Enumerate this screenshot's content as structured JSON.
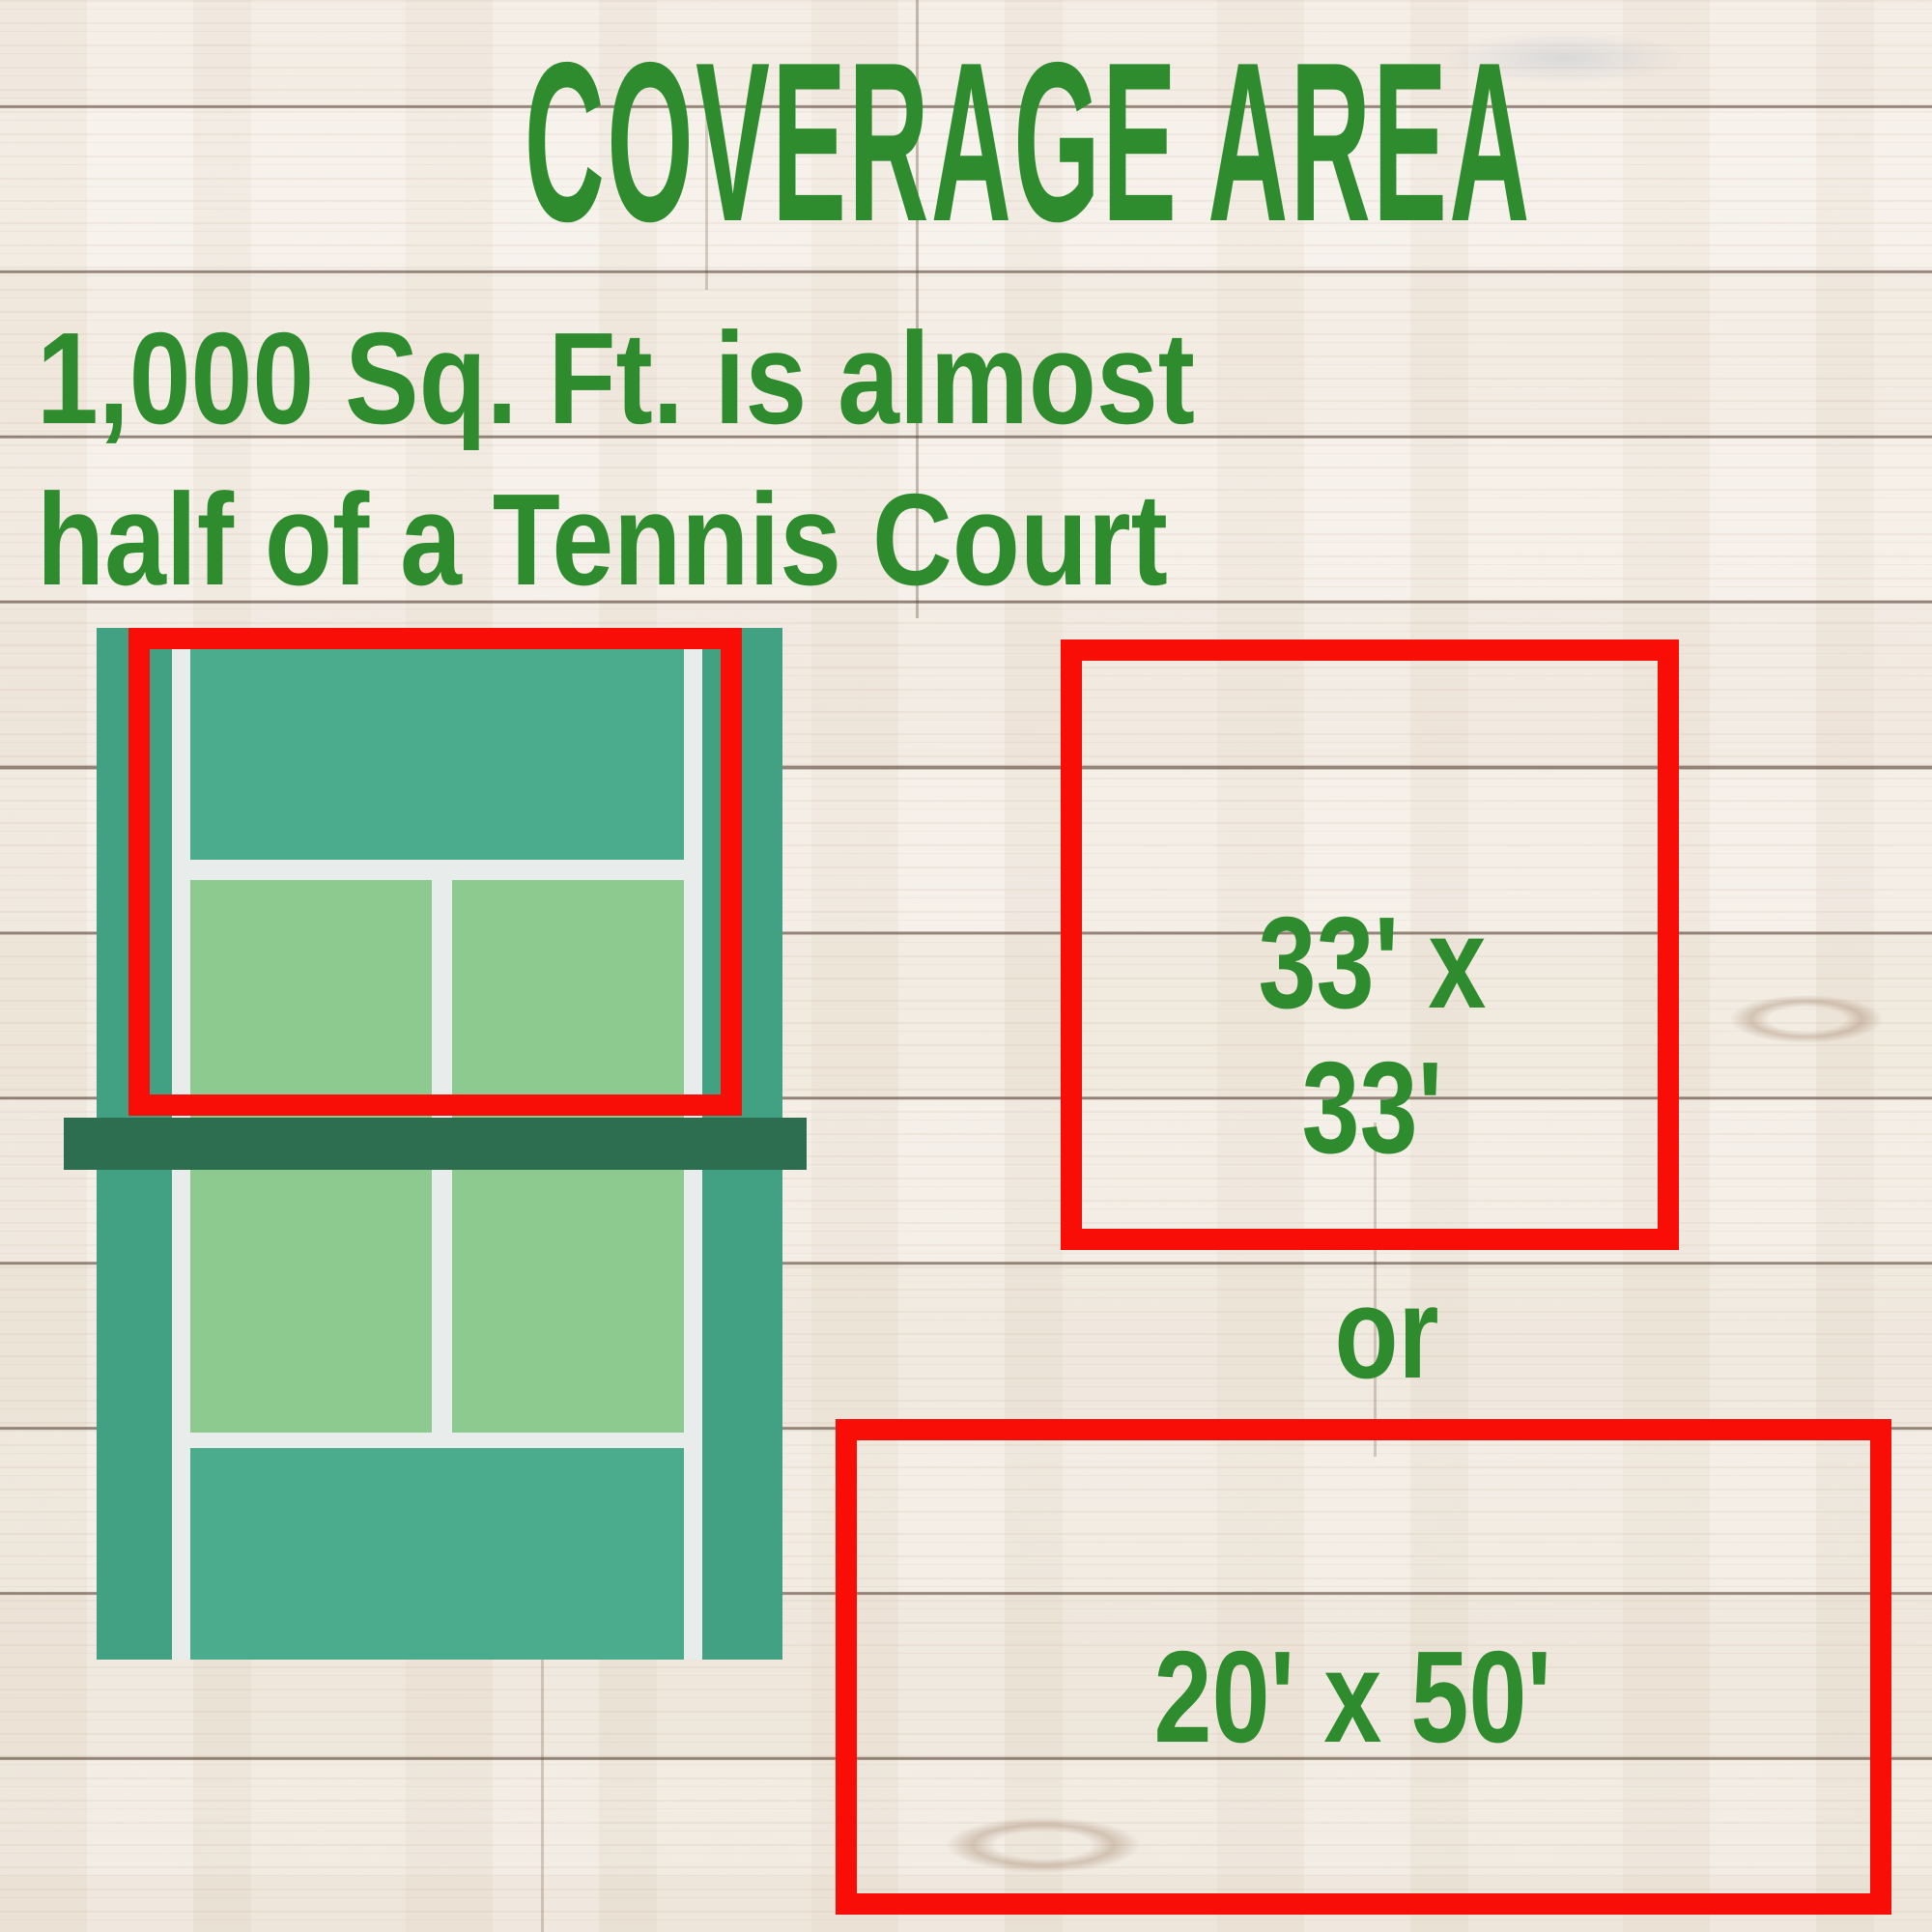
{
  "title": "COVERAGE AREA",
  "subtitle": {
    "line1": "1,000 Sq. Ft. is almost",
    "line2": "half of a Tennis Court"
  },
  "dimension_options": {
    "square_label_line1": "33' x",
    "square_label_line2": "33'",
    "separator": "or",
    "rectangle_label": "20' x 50'"
  },
  "colors": {
    "heading_green": "#2e8b2e",
    "highlight_red": "#f90d07",
    "court_surround": "#43a183",
    "court_backcourt": "#4aac8c",
    "court_service_box": "#8cca8f",
    "court_net_band": "#2d6e51",
    "court_line_white": "#e8eceb"
  }
}
